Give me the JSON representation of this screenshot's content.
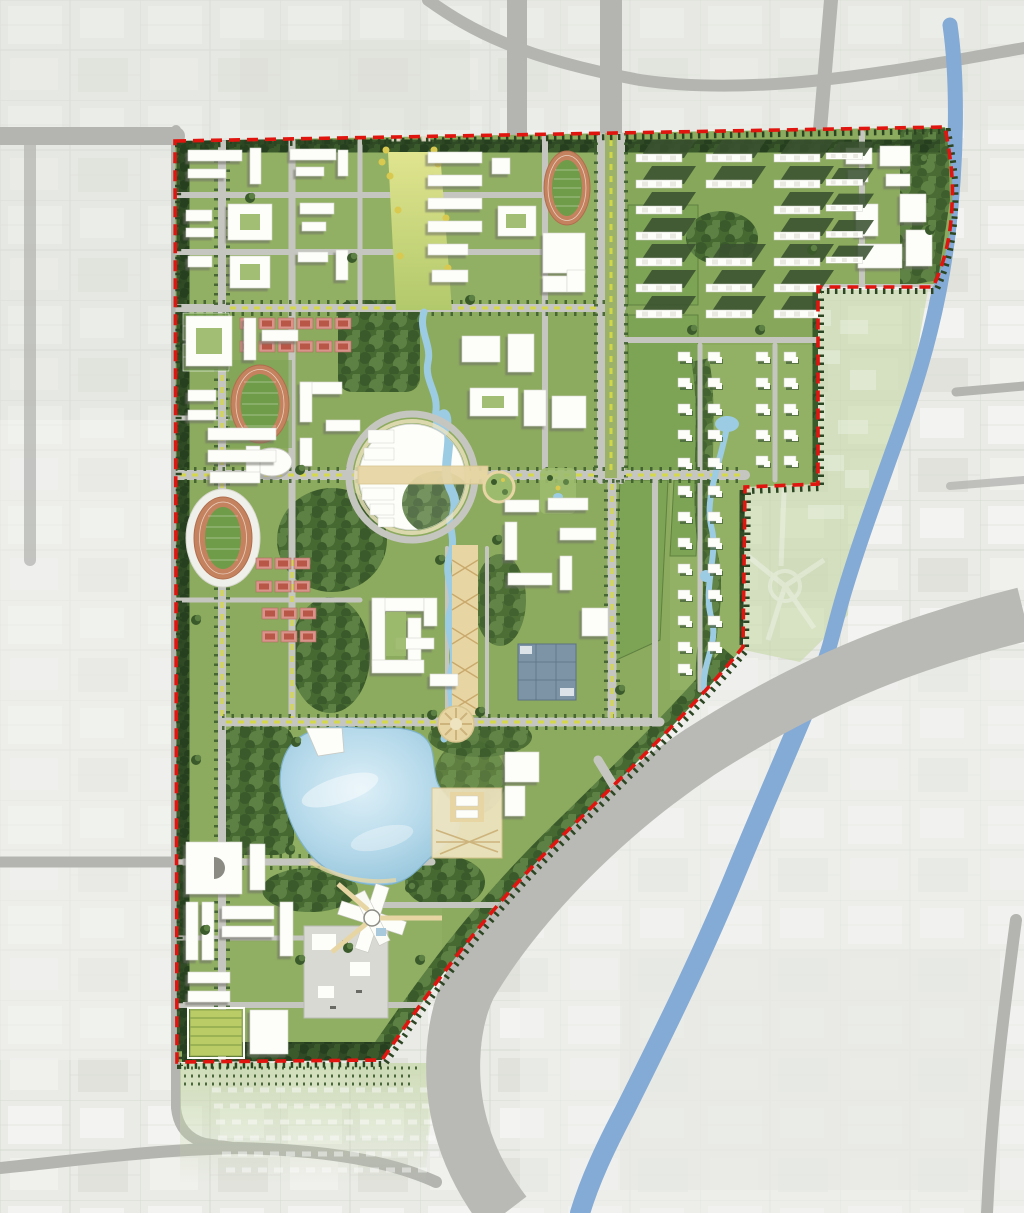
{
  "map": {
    "kind": "campus-master-plan",
    "style": "rendered site plan over grayscale aerial photograph",
    "boundary_style": "red dash-dot line with dark tree belt",
    "features": [
      "site-boundary",
      "grayscale-aerial-context",
      "arterial-roads",
      "diagonal-highway",
      "river-corridor",
      "central-lake-with-cloud-reflection",
      "winding-stream",
      "landscape-axis",
      "north-entrance-plaza",
      "circular-landmark-building",
      "round-garden",
      "radial-plaza",
      "running-track-stadium-north",
      "running-track-stadium-west",
      "stadium-with-grandstand",
      "tennis-court-clusters",
      "soccer-fields",
      "academic-building-cluster",
      "dormitory-rows",
      "high-rise-residential-slabs",
      "villa-rows-with-stream",
      "large-green-playing-fields",
      "industrial-service-buildings",
      "star-shaped-building",
      "temple-garden-complex",
      "blue-roof-complex",
      "reserved-development-area-tinted",
      "village-ghost-rows",
      "tree-shelterbelts"
    ]
  },
  "colors": {
    "photo_bg": "#eaebe7",
    "photo_line": "#d6d8d2",
    "photo_patch_light": "#f3f4f1",
    "photo_patch_dark": "#dfe1db",
    "road_outer": "#b4b5b1",
    "highway": "#b9bab5",
    "road_inner": "#c6c6c0",
    "river": "#84aad6",
    "stream": "#9ccbe4",
    "lake_edge": "#7fb3cc",
    "campus_green": "#8cab5e",
    "lawn_light": "#9dbb6d",
    "field_green": "#7da355",
    "canopy1": "#466831",
    "canopy2": "#3a5a2b",
    "canopy3": "#5d8044",
    "belt_dark": "#2f4a25",
    "building_white": "#fdfdfa",
    "roof_gray": "#d9d9d3",
    "roof_blue": "#7d94a6",
    "slab_shadow": "#3a5130",
    "track": "#c5825f",
    "pitch": "#6f9c49",
    "court_pink": "#d9938a",
    "court_red": "#b85747",
    "plaza_tan": "#e7d6a4",
    "plaza_light": "#efe4c0",
    "median_yellow": "#d5d948",
    "tree_yellow": "#d9c94e",
    "boundary_red": "#e0150f",
    "boundary_tree": "#2c4522",
    "tint_green": "#c6d8a8",
    "ghost_white": "#f4f6ee"
  }
}
